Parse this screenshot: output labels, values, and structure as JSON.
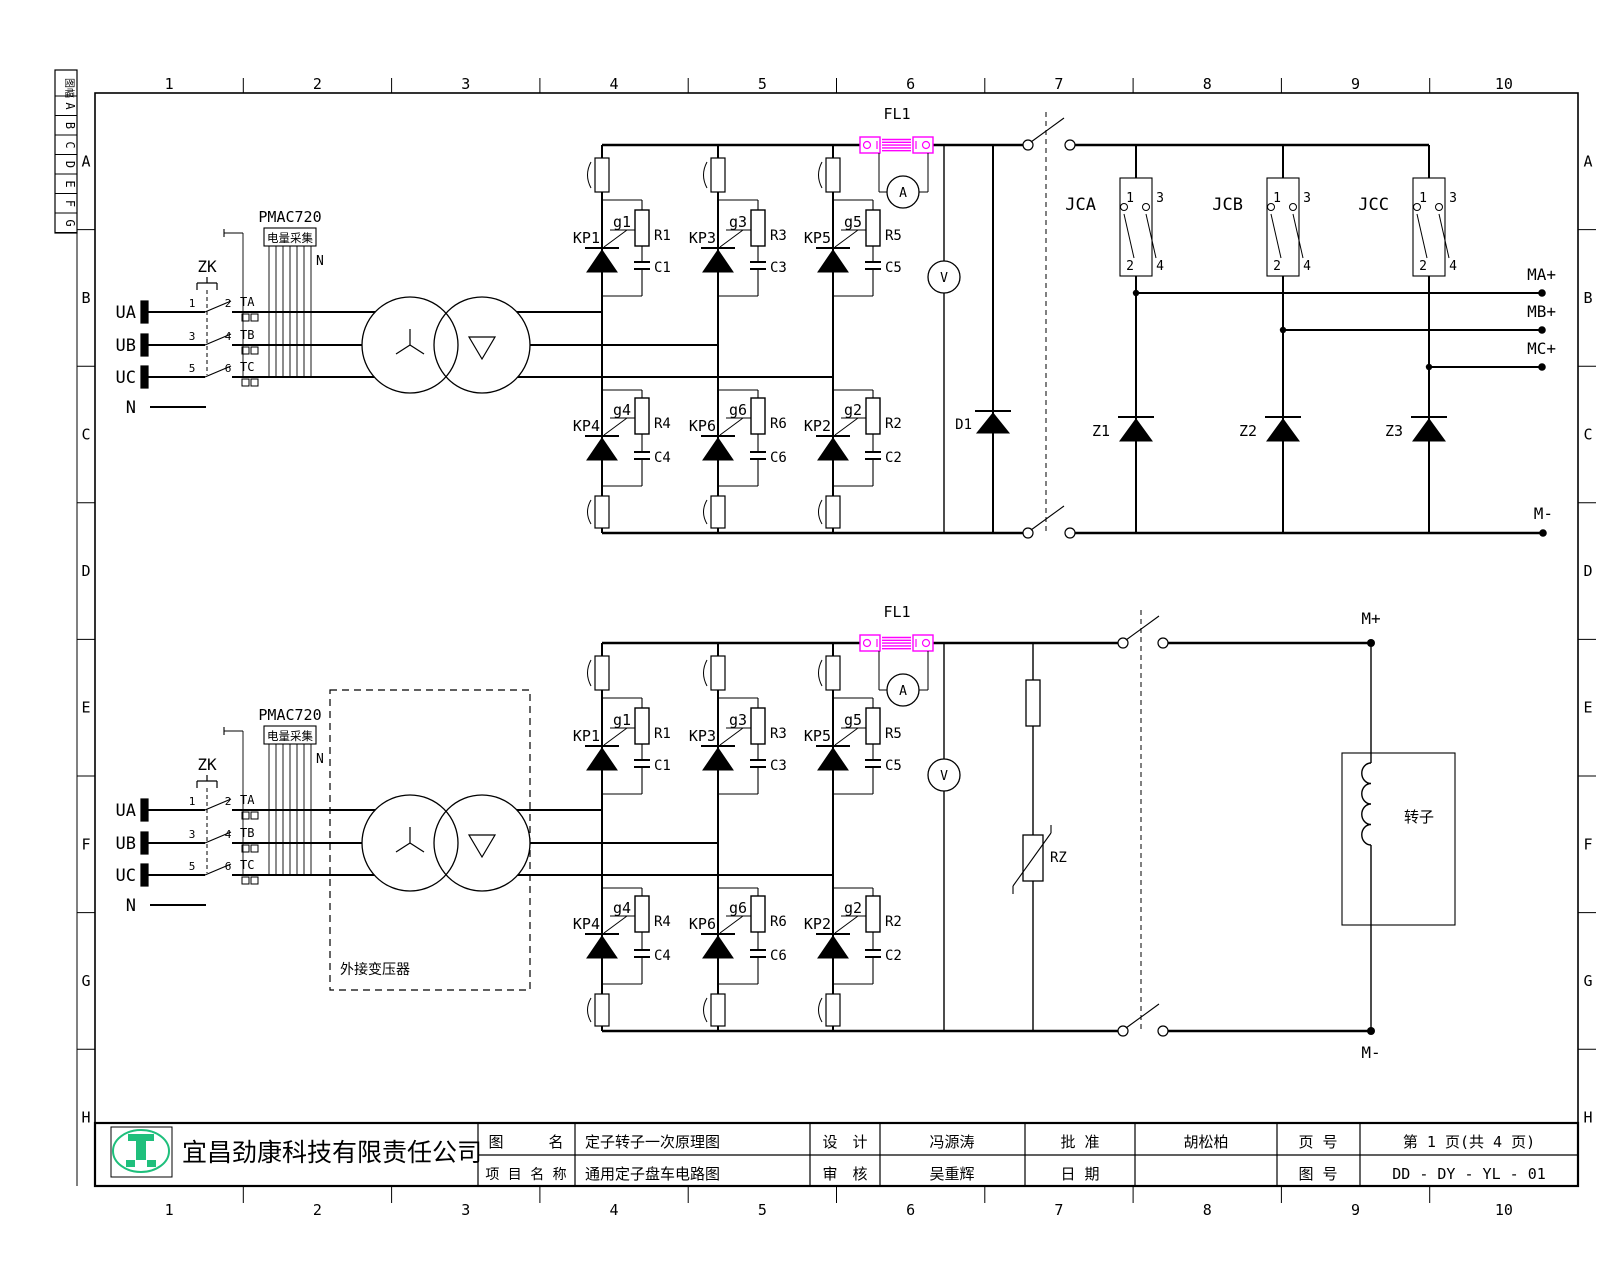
{
  "drawing": {
    "grid": {
      "columns": [
        "1",
        "2",
        "3",
        "4",
        "5",
        "6",
        "7",
        "8",
        "9",
        "10"
      ],
      "rows": [
        "A",
        "B",
        "C",
        "D",
        "E",
        "F",
        "G",
        "H"
      ],
      "strip_header": "图幅",
      "strip_rows": [
        "A",
        "B",
        "C",
        "D",
        "E",
        "F",
        "G"
      ]
    },
    "title_block": {
      "company": "宜昌劲康科技有限责任公司",
      "drawing_name_label": "图　　　名",
      "drawing_name": "定子转子一次原理图",
      "project_name_label": "项 目 名 称",
      "project_name": "通用定子盘车电路图",
      "design_label": "设　计",
      "designer": "冯源涛",
      "review_label": "审　核",
      "reviewer": "吴重辉",
      "approve_label": "批 准",
      "approver": "胡松柏",
      "date_label": "日 期",
      "date_value": "",
      "page_label": "页 号",
      "page_value": "第 1 页(共 4 页)",
      "number_label": "图 号",
      "number_value": "DD - DY - YL - 01"
    },
    "colors": {
      "shunt_magenta": "#ff00ff",
      "logo_green": "#1fbf7c",
      "line_black": "#000000"
    }
  },
  "stator": {
    "inputs": {
      "ua": "UA",
      "ub": "UB",
      "uc": "UC",
      "n": "N"
    },
    "breaker": "ZK",
    "contact_nums": [
      "1",
      "2",
      "3",
      "4",
      "5",
      "6"
    ],
    "cts": [
      "TA",
      "TB",
      "TC"
    ],
    "pmac": {
      "model": "PMAC720",
      "caption": "电量采集",
      "n": "N"
    },
    "shunt": "FL1",
    "ammeter": "A",
    "voltmeter": "V",
    "bus_diode": "D1",
    "legs": [
      {
        "kp_u": "KP1",
        "g_u": "g1",
        "r_u": "R1",
        "c_u": "C1",
        "kp_l": "KP4",
        "g_l": "g4",
        "r_l": "R4",
        "c_l": "C4"
      },
      {
        "kp_u": "KP3",
        "g_u": "g3",
        "r_u": "R3",
        "c_u": "C3",
        "kp_l": "KP6",
        "g_l": "g6",
        "r_l": "R6",
        "c_l": "C6"
      },
      {
        "kp_u": "KP5",
        "g_u": "g5",
        "r_u": "R5",
        "c_u": "C5",
        "kp_l": "KP2",
        "g_l": "g2",
        "r_l": "R2",
        "c_l": "C2"
      }
    ],
    "contactors": [
      {
        "name": "JCA",
        "t1": "1",
        "t2": "2",
        "t3": "3",
        "t4": "4"
      },
      {
        "name": "JCB",
        "t1": "1",
        "t2": "2",
        "t3": "3",
        "t4": "4"
      },
      {
        "name": "JCC",
        "t1": "1",
        "t2": "2",
        "t3": "3",
        "t4": "4"
      }
    ],
    "fw_diodes": [
      "Z1",
      "Z2",
      "Z3"
    ],
    "outputs": [
      "MA+",
      "MB+",
      "MC+"
    ],
    "neg_output": "M-"
  },
  "rotor": {
    "inputs": {
      "ua": "UA",
      "ub": "UB",
      "uc": "UC",
      "n": "N"
    },
    "breaker": "ZK",
    "contact_nums": [
      "1",
      "2",
      "3",
      "4",
      "5",
      "6"
    ],
    "cts": [
      "TA",
      "TB",
      "TC"
    ],
    "pmac": {
      "model": "PMAC720",
      "caption": "电量采集",
      "n": "N"
    },
    "shunt": "FL1",
    "ammeter": "A",
    "voltmeter": "V",
    "varistor": "RZ",
    "legs": [
      {
        "kp_u": "KP1",
        "g_u": "g1",
        "r_u": "R1",
        "c_u": "C1",
        "kp_l": "KP4",
        "g_l": "g4",
        "r_l": "R4",
        "c_l": "C4"
      },
      {
        "kp_u": "KP3",
        "g_u": "g3",
        "r_u": "R3",
        "c_u": "C3",
        "kp_l": "KP6",
        "g_l": "g6",
        "r_l": "R6",
        "c_l": "C6"
      },
      {
        "kp_u": "KP5",
        "g_u": "g5",
        "r_u": "R5",
        "c_u": "C5",
        "kp_l": "KP2",
        "g_l": "g2",
        "r_l": "R2",
        "c_l": "C2"
      }
    ],
    "ext_transformer": "外接变压器",
    "rotor_box": "转子",
    "pos_output": "M+",
    "neg_output": "M-"
  }
}
